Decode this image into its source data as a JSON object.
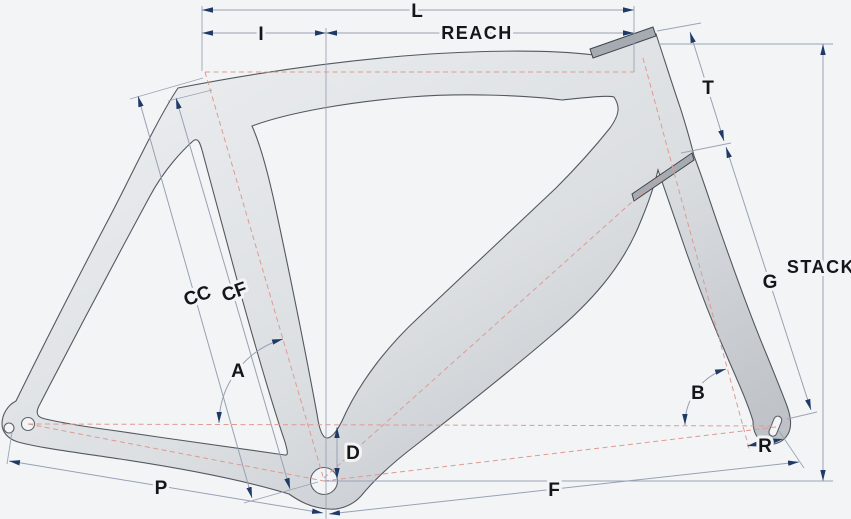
{
  "diagram": {
    "kind": "bicycle-frame-geometry",
    "colors": {
      "background": "#f3f4f6",
      "frame_fill_light": "#eef0f2",
      "frame_fill_dark": "#b6bac0",
      "frame_outline": "#53585f",
      "dimension_line": "#97a1b4",
      "arrowhead": "#1f3a66",
      "axis_dashed": "#df9a91",
      "label_text": "#14171a",
      "hardware_bar": "#a6abb2"
    },
    "labels": {
      "top_tube_L": "L",
      "offset_I": "I",
      "reach": "REACH",
      "head_tube_T": "T",
      "stack": "STACK",
      "fork_G": "G",
      "seat_tube_CC": "CC",
      "seat_tube_CF": "CF",
      "seat_angle_A": "A",
      "head_angle_B": "B",
      "bb_drop_D": "D",
      "fork_rake_R": "R",
      "chainstay_P": "P",
      "front_center_F": "F"
    }
  }
}
